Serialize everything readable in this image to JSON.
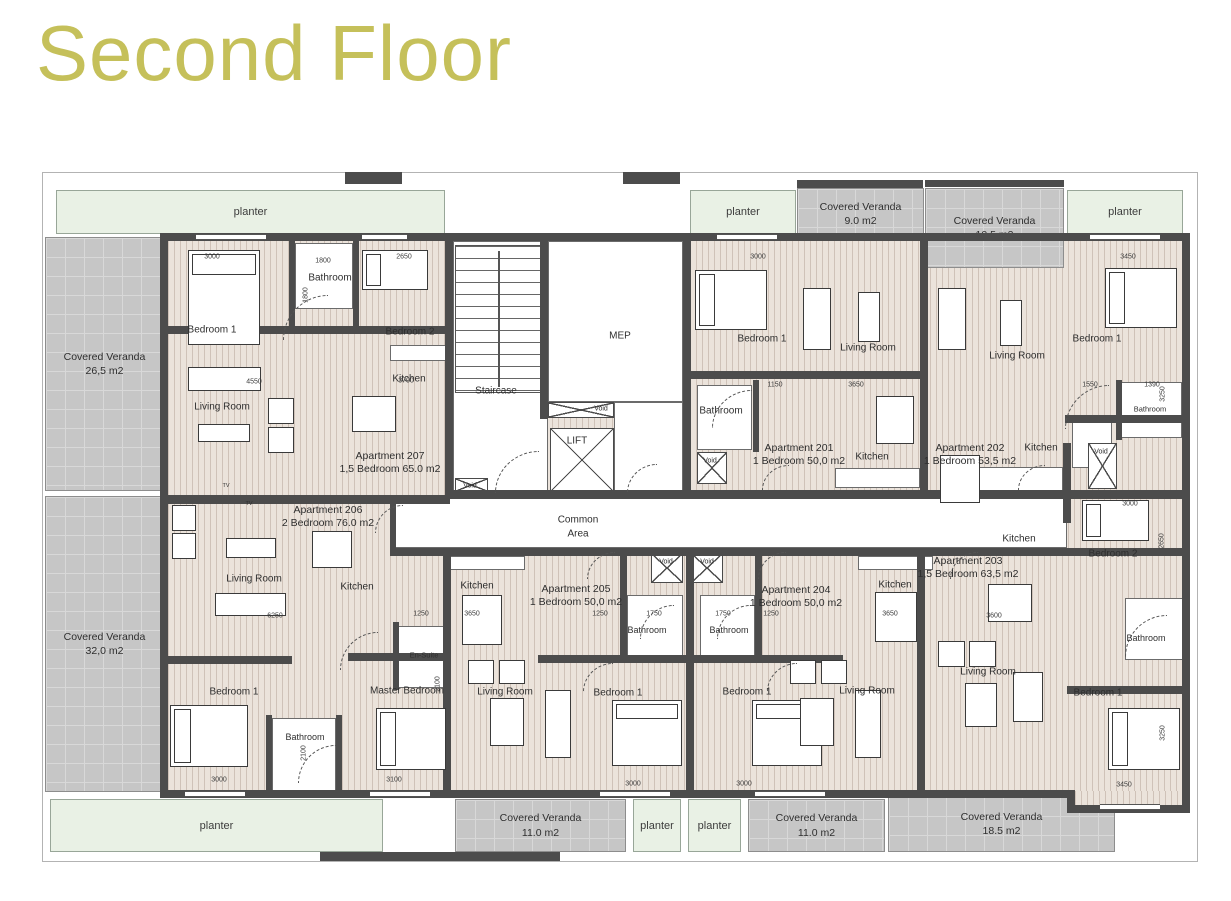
{
  "title": {
    "text": "Second Floor"
  },
  "colors": {
    "title": "#c5c05a",
    "wall": "#4c4c4c",
    "floor": "#ebe3db",
    "floor_stripe": "#cfc2b8",
    "veranda": "#c6c6c6",
    "planter": "#e9f1e5",
    "label": "#2e2e2e"
  },
  "plan": {
    "boundary": [
      42,
      172,
      1156,
      690
    ],
    "floors": [
      [
        168,
        241,
        1014,
        550
      ]
    ],
    "patches": [
      [
        1075,
        791,
        107,
        14
      ]
    ],
    "planters": [
      {
        "label": "planter",
        "x": 56,
        "y": 190,
        "w": 389,
        "h": 44
      },
      {
        "label": "planter",
        "x": 690,
        "y": 190,
        "w": 106,
        "h": 44
      },
      {
        "label": "planter",
        "x": 1067,
        "y": 190,
        "w": 116,
        "h": 44
      },
      {
        "label": "planter",
        "x": 50,
        "y": 799,
        "w": 333,
        "h": 53
      },
      {
        "label": "planter",
        "x": 633,
        "y": 799,
        "w": 48,
        "h": 53
      },
      {
        "label": "planter",
        "x": 688,
        "y": 799,
        "w": 53,
        "h": 53
      }
    ],
    "verandas": [
      {
        "name": "Covered Veranda",
        "area": "9.0 m2",
        "x": 797,
        "y": 188,
        "w": 127,
        "h": 52
      },
      {
        "name": "Covered Veranda",
        "area": "10.5 m2",
        "x": 925,
        "y": 188,
        "w": 139,
        "h": 80
      },
      {
        "name": "Covered Veranda",
        "area": "26,5 m2",
        "x": 45,
        "y": 237,
        "w": 119,
        "h": 254
      },
      {
        "name": "Covered Veranda",
        "area": "32,0 m2",
        "x": 45,
        "y": 496,
        "w": 119,
        "h": 296
      },
      {
        "name": "Covered Veranda",
        "area": "11.0 m2",
        "x": 455,
        "y": 799,
        "w": 171,
        "h": 53
      },
      {
        "name": "Covered Veranda",
        "area": "11.0 m2",
        "x": 748,
        "y": 799,
        "w": 137,
        "h": 53
      },
      {
        "name": "Covered Veranda",
        "area": "18.5 m2",
        "x": 888,
        "y": 796,
        "w": 227,
        "h": 56
      }
    ],
    "white_rooms": [
      [
        453,
        241,
        95,
        250
      ],
      [
        548,
        241,
        135,
        161
      ],
      [
        614,
        402,
        69,
        90
      ],
      [
        395,
        498,
        672,
        50
      ],
      [
        295,
        243,
        58,
        66
      ],
      [
        697,
        385,
        55,
        65
      ],
      [
        1120,
        382,
        62,
        56
      ],
      [
        627,
        595,
        56,
        66
      ],
      [
        700,
        595,
        55,
        66
      ],
      [
        1125,
        598,
        58,
        62
      ],
      [
        272,
        718,
        64,
        74
      ],
      [
        398,
        626,
        49,
        62
      ],
      [
        390,
        345,
        58,
        16
      ],
      [
        835,
        468,
        85,
        20
      ],
      [
        977,
        467,
        86,
        24
      ],
      [
        450,
        556,
        75,
        14
      ],
      [
        858,
        556,
        75,
        14
      ],
      [
        1072,
        420,
        40,
        48
      ]
    ],
    "walls": [
      [
        160,
        233,
        1030,
        8
      ],
      [
        160,
        233,
        8,
        565
      ],
      [
        1182,
        233,
        8,
        578
      ],
      [
        160,
        790,
        915,
        8
      ],
      [
        1067,
        805,
        123,
        8
      ],
      [
        1067,
        790,
        8,
        21
      ],
      [
        445,
        233,
        8,
        260
      ],
      [
        540,
        233,
        8,
        186
      ],
      [
        683,
        233,
        8,
        260
      ],
      [
        920,
        233,
        8,
        260
      ],
      [
        160,
        495,
        290,
        9
      ],
      [
        445,
        490,
        745,
        9
      ],
      [
        390,
        548,
        800,
        8
      ],
      [
        443,
        556,
        8,
        240
      ],
      [
        686,
        548,
        8,
        248
      ],
      [
        917,
        548,
        8,
        248
      ],
      [
        1063,
        443,
        8,
        80
      ],
      [
        160,
        326,
        293,
        8
      ],
      [
        691,
        371,
        237,
        8
      ],
      [
        1065,
        415,
        125,
        8
      ],
      [
        160,
        656,
        132,
        8
      ],
      [
        348,
        653,
        100,
        8
      ],
      [
        538,
        655,
        153,
        8
      ],
      [
        690,
        655,
        153,
        8
      ],
      [
        1067,
        686,
        123,
        8
      ],
      [
        289,
        241,
        6,
        88
      ],
      [
        353,
        241,
        6,
        88
      ],
      [
        320,
        852,
        240,
        9
      ],
      [
        797,
        180,
        126,
        8
      ],
      [
        925,
        180,
        139,
        7
      ],
      [
        345,
        172,
        57,
        12
      ],
      [
        623,
        172,
        57,
        12
      ],
      [
        620,
        548,
        7,
        112
      ],
      [
        755,
        548,
        7,
        112
      ],
      [
        390,
        498,
        6,
        50
      ],
      [
        266,
        715,
        6,
        76
      ],
      [
        336,
        715,
        6,
        76
      ],
      [
        393,
        622,
        6,
        68
      ],
      [
        1116,
        380,
        6,
        60
      ],
      [
        753,
        380,
        6,
        72
      ]
    ],
    "windows": [
      [
        196,
        234,
        70
      ],
      [
        362,
        234,
        45
      ],
      [
        717,
        234,
        60
      ],
      [
        1090,
        234,
        70
      ],
      [
        185,
        791,
        60
      ],
      [
        370,
        791,
        60
      ],
      [
        600,
        791,
        70
      ],
      [
        755,
        791,
        70
      ],
      [
        1100,
        804,
        60
      ]
    ],
    "stairs": [
      455,
      245,
      86,
      148
    ],
    "xboxes": [
      [
        550,
        428,
        64,
        64
      ],
      [
        548,
        402,
        66,
        16
      ],
      [
        455,
        478,
        33,
        14
      ],
      [
        697,
        452,
        30,
        32
      ],
      [
        1088,
        443,
        29,
        46
      ],
      [
        651,
        553,
        32,
        30
      ],
      [
        691,
        553,
        32,
        30
      ]
    ],
    "beds": [
      {
        "x": 188,
        "y": 250,
        "w": 72,
        "h": 95,
        "o": "v"
      },
      {
        "x": 362,
        "y": 250,
        "w": 66,
        "h": 40,
        "o": "h"
      },
      {
        "x": 695,
        "y": 270,
        "w": 72,
        "h": 60,
        "o": "h"
      },
      {
        "x": 1105,
        "y": 268,
        "w": 72,
        "h": 60,
        "o": "h"
      },
      {
        "x": 1082,
        "y": 500,
        "w": 67,
        "h": 41,
        "o": "h"
      },
      {
        "x": 1108,
        "y": 708,
        "w": 72,
        "h": 62,
        "o": "h"
      },
      {
        "x": 170,
        "y": 705,
        "w": 78,
        "h": 62,
        "o": "h"
      },
      {
        "x": 376,
        "y": 708,
        "w": 70,
        "h": 62,
        "o": "h"
      },
      {
        "x": 612,
        "y": 700,
        "w": 70,
        "h": 66,
        "o": "v"
      },
      {
        "x": 752,
        "y": 700,
        "w": 70,
        "h": 66,
        "o": "v"
      }
    ],
    "sofas": [
      [
        188,
        367,
        73,
        24
      ],
      [
        215,
        593,
        71,
        23
      ],
      [
        803,
        288,
        28,
        62
      ],
      [
        938,
        288,
        28,
        62
      ],
      [
        545,
        690,
        26,
        68
      ],
      [
        855,
        690,
        26,
        68
      ],
      [
        1013,
        672,
        30,
        50
      ]
    ],
    "tables": [
      [
        198,
        424,
        52,
        18
      ],
      [
        352,
        396,
        44,
        36
      ],
      [
        226,
        538,
        50,
        20
      ],
      [
        312,
        531,
        40,
        37
      ],
      [
        858,
        292,
        22,
        50
      ],
      [
        876,
        396,
        38,
        48
      ],
      [
        1000,
        300,
        22,
        46
      ],
      [
        940,
        455,
        40,
        48
      ],
      [
        462,
        595,
        40,
        50
      ],
      [
        875,
        592,
        42,
        50
      ],
      [
        988,
        584,
        44,
        38
      ],
      [
        490,
        698,
        34,
        48
      ],
      [
        800,
        698,
        34,
        48
      ],
      [
        965,
        683,
        32,
        44
      ]
    ],
    "chairs": [
      [
        268,
        398,
        26,
        26
      ],
      [
        268,
        427,
        26,
        26
      ],
      [
        172,
        505,
        24,
        26
      ],
      [
        172,
        533,
        24,
        26
      ],
      [
        468,
        660,
        26,
        24
      ],
      [
        499,
        660,
        26,
        24
      ],
      [
        790,
        660,
        26,
        24
      ],
      [
        821,
        660,
        26,
        24
      ],
      [
        938,
        641,
        27,
        26
      ],
      [
        969,
        641,
        27,
        26
      ]
    ],
    "arcs": [
      [
        283,
        295,
        45,
        45
      ],
      [
        495,
        451,
        44,
        42
      ],
      [
        627,
        464,
        30,
        29
      ],
      [
        762,
        465,
        27,
        25
      ],
      [
        1018,
        465,
        27,
        25
      ],
      [
        375,
        505,
        28,
        28
      ],
      [
        587,
        552,
        28,
        27
      ],
      [
        758,
        552,
        28,
        27
      ],
      [
        950,
        552,
        28,
        27
      ],
      [
        340,
        632,
        38,
        38
      ],
      [
        298,
        745,
        38,
        38
      ],
      [
        640,
        605,
        34,
        34
      ],
      [
        717,
        605,
        34,
        34
      ],
      [
        1125,
        615,
        42,
        42
      ],
      [
        1065,
        385,
        44,
        44
      ],
      [
        712,
        390,
        40,
        38
      ],
      [
        583,
        663,
        30,
        29
      ],
      [
        767,
        663,
        30,
        29
      ]
    ],
    "room_labels": [
      {
        "t": "Bedroom 1",
        "x": 212,
        "y": 330
      },
      {
        "t": "Bathroom",
        "x": 330,
        "y": 278
      },
      {
        "t": "Bedroom 2",
        "x": 410,
        "y": 332
      },
      {
        "t": "Kitchen",
        "x": 409,
        "y": 379
      },
      {
        "t": "Living Room",
        "x": 222,
        "y": 407
      },
      {
        "t": "MEP",
        "x": 620,
        "y": 336
      },
      {
        "t": "Staircase",
        "x": 496,
        "y": 391
      },
      {
        "t": "LIFT",
        "x": 577,
        "y": 441
      },
      {
        "t": "Bedroom 1",
        "x": 762,
        "y": 339
      },
      {
        "t": "Living Room",
        "x": 868,
        "y": 348
      },
      {
        "t": "Bathroom",
        "x": 721,
        "y": 411
      },
      {
        "t": "Kitchen",
        "x": 872,
        "y": 457
      },
      {
        "t": "Living Room",
        "x": 1017,
        "y": 356
      },
      {
        "t": "Bedroom 1",
        "x": 1097,
        "y": 339
      },
      {
        "t": "Bathroom",
        "x": 1150,
        "y": 409,
        "s": 7.5
      },
      {
        "t": "Kitchen",
        "x": 1041,
        "y": 448
      },
      {
        "t": "Common",
        "x": 578,
        "y": 520
      },
      {
        "t": "Area",
        "x": 578,
        "y": 534
      },
      {
        "t": "Living Room",
        "x": 254,
        "y": 579
      },
      {
        "t": "Kitchen",
        "x": 357,
        "y": 587
      },
      {
        "t": "Kitchen",
        "x": 477,
        "y": 586
      },
      {
        "t": "Kitchen",
        "x": 895,
        "y": 585
      },
      {
        "t": "Kitchen",
        "x": 1019,
        "y": 539
      },
      {
        "t": "Bedroom 2",
        "x": 1113,
        "y": 554
      },
      {
        "t": "Bathroom",
        "x": 647,
        "y": 630,
        "s": 9
      },
      {
        "t": "Bathroom",
        "x": 729,
        "y": 630,
        "s": 9
      },
      {
        "t": "Bathroom",
        "x": 1146,
        "y": 638,
        "s": 9
      },
      {
        "t": "En-Suite",
        "x": 424,
        "y": 655,
        "s": 7.5
      },
      {
        "t": "Bedroom 1",
        "x": 234,
        "y": 692
      },
      {
        "t": "Bathroom",
        "x": 305,
        "y": 737,
        "s": 9
      },
      {
        "t": "Master Bedroom",
        "x": 407,
        "y": 691
      },
      {
        "t": "Living Room",
        "x": 505,
        "y": 692
      },
      {
        "t": "Bedroom 1",
        "x": 618,
        "y": 693
      },
      {
        "t": "Bedroom 1",
        "x": 747,
        "y": 692
      },
      {
        "t": "Living Room",
        "x": 867,
        "y": 691
      },
      {
        "t": "Living Room",
        "x": 988,
        "y": 672
      },
      {
        "t": "Bedroom 1",
        "x": 1098,
        "y": 693
      },
      {
        "t": "Void",
        "x": 470,
        "y": 486,
        "s": 7
      },
      {
        "t": "Void",
        "x": 601,
        "y": 409,
        "s": 7
      },
      {
        "t": "Void",
        "x": 710,
        "y": 461,
        "s": 7
      },
      {
        "t": "Void",
        "x": 666,
        "y": 562,
        "s": 7
      },
      {
        "t": "Void",
        "x": 707,
        "y": 562,
        "s": 7
      },
      {
        "t": "Void",
        "x": 1101,
        "y": 452,
        "s": 7
      },
      {
        "t": "TV",
        "x": 226,
        "y": 486,
        "s": 5.5
      },
      {
        "t": "TV",
        "x": 249,
        "y": 504,
        "s": 5.5
      }
    ],
    "apartments": [
      {
        "name": "Apartment 207",
        "size": "1,5 Bedroom 65.0 m2",
        "x": 390,
        "y": 463
      },
      {
        "name": "Apartment 206",
        "size": "2 Bedroom 76.0 m2",
        "x": 328,
        "y": 517
      },
      {
        "name": "Apartment 205",
        "size": "1 Bedroom 50,0 m2",
        "x": 576,
        "y": 596
      },
      {
        "name": "Apartment 204",
        "size": "1 Bedroom 50,0 m2",
        "x": 796,
        "y": 597
      },
      {
        "name": "Apartment 203",
        "size": "1,5 Bedroom 63,5 m2",
        "x": 968,
        "y": 568
      },
      {
        "name": "Apartment 201",
        "size": "1 Bedroom 50,0 m2",
        "x": 799,
        "y": 455
      },
      {
        "name": "Apartment 202",
        "size": "1 Bedroom 53,5 m2",
        "x": 970,
        "y": 455
      }
    ],
    "dims": [
      {
        "t": "3000",
        "x": 212,
        "y": 257
      },
      {
        "t": "1800",
        "x": 323,
        "y": 261
      },
      {
        "t": "2650",
        "x": 404,
        "y": 257
      },
      {
        "t": "1800",
        "x": 306,
        "y": 295,
        "r": 1
      },
      {
        "t": "4550",
        "x": 254,
        "y": 382
      },
      {
        "t": "3700",
        "x": 406,
        "y": 381
      },
      {
        "t": "3000",
        "x": 758,
        "y": 257
      },
      {
        "t": "3450",
        "x": 1128,
        "y": 257
      },
      {
        "t": "1150",
        "x": 775,
        "y": 385
      },
      {
        "t": "3650",
        "x": 856,
        "y": 385
      },
      {
        "t": "1550",
        "x": 1090,
        "y": 385
      },
      {
        "t": "1390",
        "x": 1152,
        "y": 385
      },
      {
        "t": "3250",
        "x": 1163,
        "y": 394,
        "r": 1
      },
      {
        "t": "1250",
        "x": 421,
        "y": 614
      },
      {
        "t": "3650",
        "x": 472,
        "y": 614
      },
      {
        "t": "1250",
        "x": 600,
        "y": 614
      },
      {
        "t": "1750",
        "x": 654,
        "y": 614
      },
      {
        "t": "1750",
        "x": 723,
        "y": 614
      },
      {
        "t": "1250",
        "x": 771,
        "y": 614
      },
      {
        "t": "3650",
        "x": 890,
        "y": 614
      },
      {
        "t": "3600",
        "x": 994,
        "y": 616
      },
      {
        "t": "6250",
        "x": 275,
        "y": 616
      },
      {
        "t": "3000",
        "x": 1130,
        "y": 504
      },
      {
        "t": "2650",
        "x": 1162,
        "y": 541,
        "r": 1
      },
      {
        "t": "2100",
        "x": 438,
        "y": 684,
        "r": 1
      },
      {
        "t": "2100",
        "x": 304,
        "y": 753,
        "r": 1
      },
      {
        "t": "3000",
        "x": 219,
        "y": 780
      },
      {
        "t": "3100",
        "x": 394,
        "y": 780
      },
      {
        "t": "3000",
        "x": 633,
        "y": 784
      },
      {
        "t": "3000",
        "x": 744,
        "y": 784
      },
      {
        "t": "3450",
        "x": 1124,
        "y": 785
      },
      {
        "t": "3250",
        "x": 1163,
        "y": 733,
        "r": 1
      }
    ]
  }
}
